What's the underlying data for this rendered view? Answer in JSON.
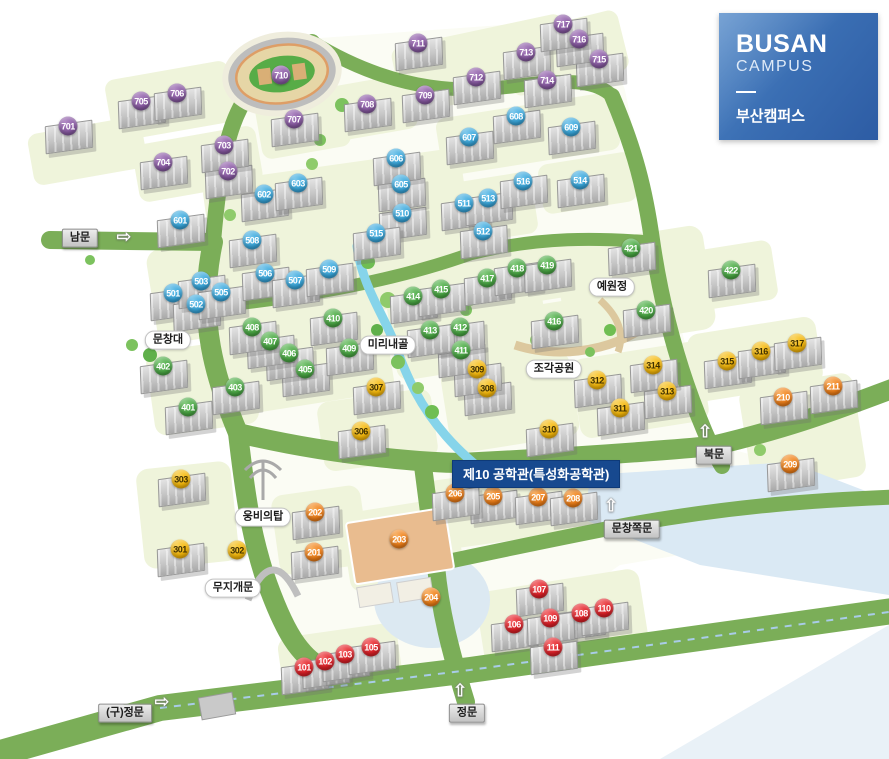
{
  "logo": {
    "line1": "BUSAN",
    "line2": "CAMPUS",
    "line3": "부산캠퍼스",
    "bg_top": "#5289c8",
    "bg_bottom": "#2d5ca4"
  },
  "tooltip": {
    "text": "제10 공학관(특성화공학관)",
    "bg": "#17498F"
  },
  "map": {
    "labels": [
      {
        "id": "south-gate",
        "text": "남문",
        "type": "gate",
        "x": 80,
        "y": 238,
        "arrow": {
          "dir": "right",
          "x": 124,
          "y": 237
        }
      },
      {
        "id": "north-gate",
        "text": "북문",
        "type": "gate",
        "x": 714,
        "y": 455,
        "arrow": {
          "dir": "up",
          "x": 705,
          "y": 432
        }
      },
      {
        "id": "main-gate",
        "text": "정문",
        "type": "gate",
        "x": 467,
        "y": 713,
        "arrow": {
          "dir": "up",
          "x": 460,
          "y": 691
        }
      },
      {
        "id": "old-main-gate",
        "text": "(구)정문",
        "type": "gate",
        "x": 125,
        "y": 713,
        "arrow": {
          "dir": "right",
          "x": 162,
          "y": 702
        }
      },
      {
        "id": "munchang-side-gate",
        "text": "문창쪽문",
        "type": "gate",
        "x": 632,
        "y": 529,
        "arrow": {
          "dir": "up",
          "x": 611,
          "y": 506
        }
      },
      {
        "id": "munchangdae",
        "text": "문창대",
        "type": "place",
        "x": 168,
        "y": 340
      },
      {
        "id": "mirinaegol",
        "text": "미리내골",
        "type": "place",
        "x": 388,
        "y": 345
      },
      {
        "id": "yewonjeong",
        "text": "예원정",
        "type": "place",
        "x": 612,
        "y": 287
      },
      {
        "id": "sculpture-park",
        "text": "조각공원",
        "type": "place",
        "x": 554,
        "y": 369
      },
      {
        "id": "ungbi-tower",
        "text": "웅비의탑",
        "type": "place",
        "x": 263,
        "y": 517
      },
      {
        "id": "rainbow-gate",
        "text": "무지개문",
        "type": "place",
        "x": 233,
        "y": 588
      }
    ],
    "marker_groups": [
      {
        "range": "100",
        "color": "#E02128",
        "hi": "#F4686B",
        "lo": "#A91318",
        "text": "#FFFFFF",
        "items": [
          {
            "n": "101",
            "x": 304,
            "y": 667
          },
          {
            "n": "102",
            "x": 325,
            "y": 661
          },
          {
            "n": "103",
            "x": 345,
            "y": 654
          },
          {
            "n": "105",
            "x": 371,
            "y": 647
          },
          {
            "n": "106",
            "x": 514,
            "y": 624
          },
          {
            "n": "107",
            "x": 539,
            "y": 589
          },
          {
            "n": "108",
            "x": 581,
            "y": 613
          },
          {
            "n": "109",
            "x": 550,
            "y": 618
          },
          {
            "n": "110",
            "x": 604,
            "y": 608
          },
          {
            "n": "111",
            "x": 553,
            "y": 647
          }
        ]
      },
      {
        "range": "200",
        "color": "#F08019",
        "hi": "#F8B063",
        "lo": "#C05E08",
        "text": "#FFFFFF",
        "items": [
          {
            "n": "201",
            "x": 314,
            "y": 552
          },
          {
            "n": "202",
            "x": 315,
            "y": 512
          },
          {
            "n": "203",
            "x": 399,
            "y": 539,
            "b": 0
          },
          {
            "n": "204",
            "x": 431,
            "y": 597,
            "b": 0
          },
          {
            "n": "205",
            "x": 493,
            "y": 496
          },
          {
            "n": "206",
            "x": 455,
            "y": 493
          },
          {
            "n": "207",
            "x": 538,
            "y": 497
          },
          {
            "n": "208",
            "x": 573,
            "y": 498
          },
          {
            "n": "209",
            "x": 790,
            "y": 464
          },
          {
            "n": "210",
            "x": 783,
            "y": 397
          },
          {
            "n": "211",
            "x": 833,
            "y": 386
          }
        ]
      },
      {
        "range": "300",
        "color": "#F5B80A",
        "hi": "#FAD45E",
        "lo": "#C98F00",
        "text": "#3F3000",
        "items": [
          {
            "n": "301",
            "x": 180,
            "y": 549
          },
          {
            "n": "302",
            "x": 237,
            "y": 550,
            "b": 0
          },
          {
            "n": "303",
            "x": 181,
            "y": 479
          },
          {
            "n": "306",
            "x": 361,
            "y": 431
          },
          {
            "n": "307",
            "x": 376,
            "y": 387
          },
          {
            "n": "308",
            "x": 487,
            "y": 388
          },
          {
            "n": "309",
            "x": 477,
            "y": 369
          },
          {
            "n": "310",
            "x": 549,
            "y": 429
          },
          {
            "n": "311",
            "x": 620,
            "y": 408
          },
          {
            "n": "312",
            "x": 597,
            "y": 380
          },
          {
            "n": "313",
            "x": 667,
            "y": 391
          },
          {
            "n": "314",
            "x": 653,
            "y": 365
          },
          {
            "n": "315",
            "x": 727,
            "y": 361
          },
          {
            "n": "316",
            "x": 761,
            "y": 351
          },
          {
            "n": "317",
            "x": 797,
            "y": 343
          }
        ]
      },
      {
        "range": "400",
        "color": "#4BA945",
        "hi": "#82C97C",
        "lo": "#2F7F2C",
        "text": "#FFFFFF",
        "items": [
          {
            "n": "401",
            "x": 188,
            "y": 407
          },
          {
            "n": "402",
            "x": 163,
            "y": 366
          },
          {
            "n": "403",
            "x": 235,
            "y": 387
          },
          {
            "n": "405",
            "x": 305,
            "y": 369
          },
          {
            "n": "406",
            "x": 289,
            "y": 353
          },
          {
            "n": "407",
            "x": 270,
            "y": 341
          },
          {
            "n": "408",
            "x": 252,
            "y": 327
          },
          {
            "n": "409",
            "x": 349,
            "y": 348
          },
          {
            "n": "410",
            "x": 333,
            "y": 318
          },
          {
            "n": "411",
            "x": 461,
            "y": 350
          },
          {
            "n": "412",
            "x": 460,
            "y": 327
          },
          {
            "n": "413",
            "x": 430,
            "y": 330
          },
          {
            "n": "414",
            "x": 413,
            "y": 296
          },
          {
            "n": "415",
            "x": 441,
            "y": 289
          },
          {
            "n": "416",
            "x": 554,
            "y": 321
          },
          {
            "n": "417",
            "x": 487,
            "y": 278
          },
          {
            "n": "418",
            "x": 517,
            "y": 268
          },
          {
            "n": "419",
            "x": 547,
            "y": 265
          },
          {
            "n": "420",
            "x": 646,
            "y": 310
          },
          {
            "n": "421",
            "x": 631,
            "y": 248
          },
          {
            "n": "422",
            "x": 731,
            "y": 270
          }
        ]
      },
      {
        "range": "500-600",
        "color": "#3AA8DC",
        "hi": "#7CC8EC",
        "lo": "#1F7FB0",
        "text": "#FFFFFF",
        "items": [
          {
            "n": "501",
            "x": 173,
            "y": 293
          },
          {
            "n": "502",
            "x": 196,
            "y": 304
          },
          {
            "n": "503",
            "x": 201,
            "y": 281
          },
          {
            "n": "505",
            "x": 221,
            "y": 292
          },
          {
            "n": "506",
            "x": 265,
            "y": 273
          },
          {
            "n": "507",
            "x": 295,
            "y": 280
          },
          {
            "n": "508",
            "x": 252,
            "y": 240
          },
          {
            "n": "509",
            "x": 329,
            "y": 269
          },
          {
            "n": "510",
            "x": 402,
            "y": 213
          },
          {
            "n": "511",
            "x": 464,
            "y": 203
          },
          {
            "n": "512",
            "x": 483,
            "y": 231
          },
          {
            "n": "513",
            "x": 488,
            "y": 198
          },
          {
            "n": "514",
            "x": 580,
            "y": 180
          },
          {
            "n": "515",
            "x": 376,
            "y": 233
          },
          {
            "n": "516",
            "x": 523,
            "y": 181
          },
          {
            "n": "601",
            "x": 180,
            "y": 220
          },
          {
            "n": "602",
            "x": 264,
            "y": 194
          },
          {
            "n": "603",
            "x": 298,
            "y": 183
          },
          {
            "n": "605",
            "x": 401,
            "y": 184
          },
          {
            "n": "606",
            "x": 396,
            "y": 158
          },
          {
            "n": "607",
            "x": 469,
            "y": 137
          },
          {
            "n": "608",
            "x": 516,
            "y": 116
          },
          {
            "n": "609",
            "x": 571,
            "y": 127
          }
        ]
      },
      {
        "range": "700",
        "color": "#8B5CA5",
        "hi": "#B18AC4",
        "lo": "#64407C",
        "text": "#FFFFFF",
        "items": [
          {
            "n": "701",
            "x": 68,
            "y": 126
          },
          {
            "n": "702",
            "x": 228,
            "y": 171
          },
          {
            "n": "703",
            "x": 224,
            "y": 145
          },
          {
            "n": "704",
            "x": 163,
            "y": 162
          },
          {
            "n": "705",
            "x": 141,
            "y": 101
          },
          {
            "n": "706",
            "x": 177,
            "y": 93
          },
          {
            "n": "707",
            "x": 294,
            "y": 119
          },
          {
            "n": "708",
            "x": 367,
            "y": 104
          },
          {
            "n": "709",
            "x": 425,
            "y": 95
          },
          {
            "n": "710",
            "x": 281,
            "y": 75,
            "b": 0
          },
          {
            "n": "711",
            "x": 418,
            "y": 43
          },
          {
            "n": "712",
            "x": 476,
            "y": 77
          },
          {
            "n": "713",
            "x": 526,
            "y": 52
          },
          {
            "n": "714",
            "x": 547,
            "y": 80
          },
          {
            "n": "715",
            "x": 599,
            "y": 59
          },
          {
            "n": "716",
            "x": 579,
            "y": 39
          },
          {
            "n": "717",
            "x": 563,
            "y": 24
          }
        ]
      }
    ]
  }
}
